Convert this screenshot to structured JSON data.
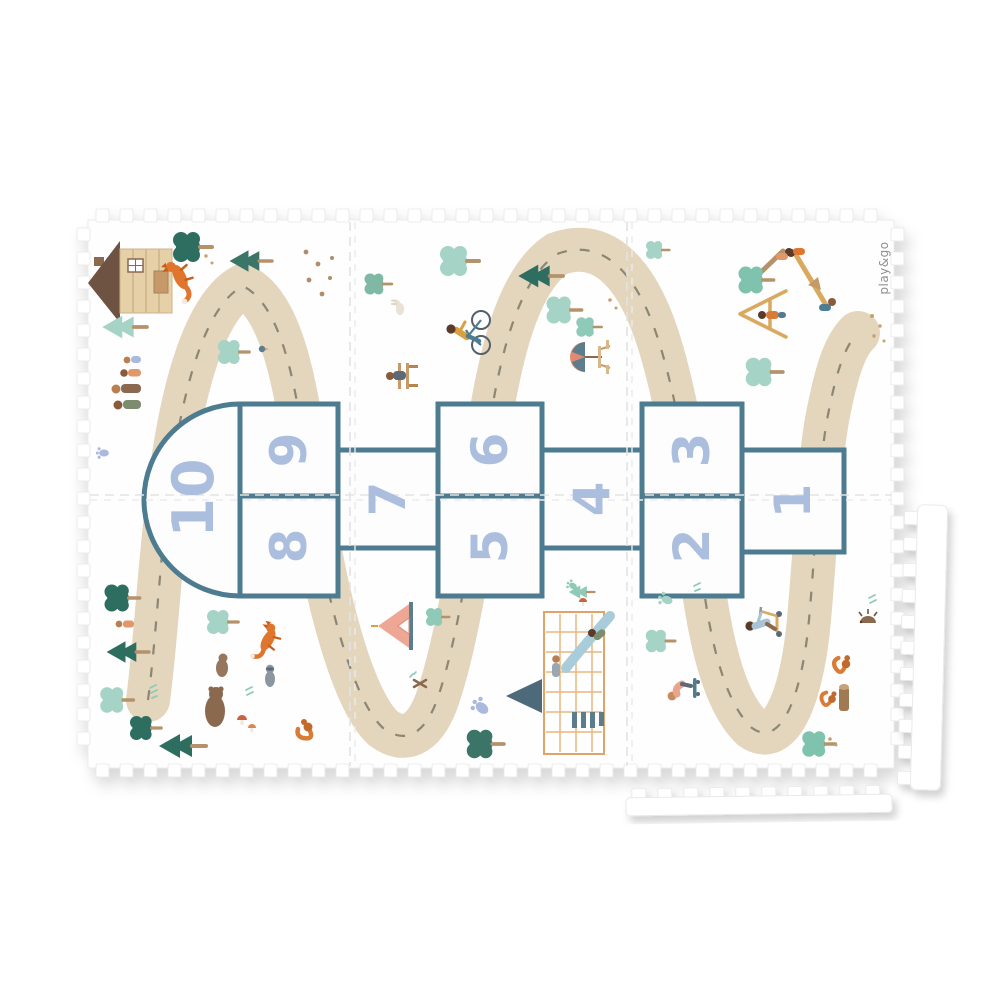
{
  "brand": {
    "logo_text": "play&go"
  },
  "hopscotch": {
    "numbers": [
      "10",
      "9",
      "8",
      "7",
      "6",
      "5",
      "4",
      "3",
      "2",
      "1"
    ],
    "border_color": "#4e7b90",
    "number_color": "#abbede"
  },
  "mat": {
    "tile_columns": 3,
    "tile_rows": 2,
    "loose_edge_strips": 2,
    "base_color": "#fefefe",
    "road_color": "#e4d5bd",
    "road_dash_color": "#8a8775",
    "accent_colors": {
      "dark_teal": "#2f6e60",
      "mint": "#a5d3c6",
      "wood": "#b5926b",
      "tan": "#d9a95f",
      "slate": "#4d7d92",
      "orange": "#e0762f",
      "brown": "#8a6950",
      "pink": "#efa795",
      "periwinkle": "#aab9dd"
    }
  },
  "illustrations": [
    "cabin",
    "fox",
    "fox-leaping",
    "paw-prints",
    "family-walk",
    "pine-tree",
    "blob-tree",
    "cyclist",
    "bench-reader",
    "rabbit",
    "picnic-umbrella",
    "tree-climb-kid",
    "seesaw-kids",
    "swing-frame-kid",
    "bears",
    "raccoon",
    "mushrooms",
    "squirrel",
    "small-kid",
    "tent",
    "campfire",
    "play-tower-slide",
    "footprints",
    "scooter-kid",
    "skateboard-kid",
    "tree-stump-squirrel",
    "hedgehog",
    "leaf-spade",
    "bird"
  ]
}
